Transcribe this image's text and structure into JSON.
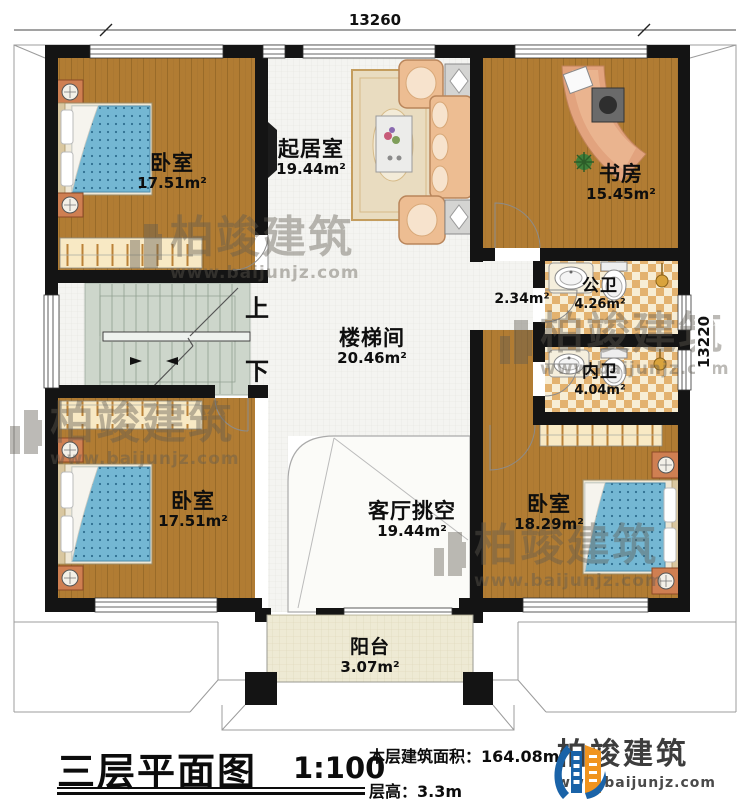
{
  "dimensions": {
    "top": "13260",
    "right": "13220"
  },
  "rooms": {
    "bedroom_tl": {
      "name": "卧室",
      "area": "17.51m²"
    },
    "living": {
      "name": "起居室",
      "area": "19.44m²"
    },
    "study": {
      "name": "书房",
      "area": "15.45m²"
    },
    "bath_public": {
      "name": "公卫",
      "area": "4.26m²"
    },
    "hallway": {
      "area": "2.34m²"
    },
    "bath_private": {
      "name": "内卫",
      "area": "4.04m²"
    },
    "stairwell": {
      "name": "楼梯间",
      "area": "20.46m²"
    },
    "bedroom_bl": {
      "name": "卧室",
      "area": "17.51m²"
    },
    "void": {
      "name": "客厅挑空",
      "area": "19.44m²"
    },
    "bedroom_br": {
      "name": "卧室",
      "area": "18.29m²"
    },
    "balcony": {
      "name": "阳台",
      "area": "3.07m²"
    }
  },
  "stairs": {
    "up": "上",
    "down": "下"
  },
  "watermark": {
    "name": "柏竣建筑",
    "url": "www.baijunjz.com"
  },
  "footer": {
    "title": "三层平面图",
    "scale": "1:100",
    "area_label": "本层建筑面积：",
    "area_value": "164.08m²",
    "floor_height_label": "层高：",
    "floor_height_value": "3.3m"
  },
  "logo": {
    "name": "柏竣建筑",
    "url": "www.baijunjz.com"
  },
  "colors": {
    "wall": "#141414",
    "wood": "#b17c33",
    "bed_blue": "#74b7d3",
    "tile_checker": "#e3b26f",
    "stair_green": "#cdd6cb",
    "logo_blue": "#1a63a8",
    "logo_orange": "#f0941f"
  }
}
